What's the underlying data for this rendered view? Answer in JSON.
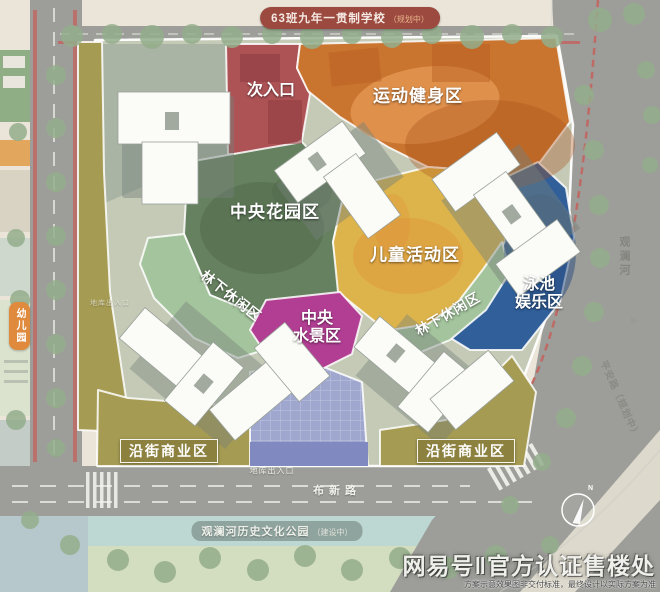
{
  "badges": {
    "school": {
      "name": "63班九年一贯制学校",
      "status": "（规划中）"
    },
    "kindergarten": {
      "name": "幼儿园"
    },
    "park": {
      "name": "观澜河历史文化公园",
      "status": "（建设中）"
    }
  },
  "zones": {
    "secondary_entrance": {
      "label": "次入口"
    },
    "sports": {
      "label": "运动健身区"
    },
    "garden": {
      "label": "中央花园区"
    },
    "children": {
      "label": "儿童活动区"
    },
    "forest_left": {
      "label": "林下休闲区"
    },
    "waterscape": {
      "line1": "中央",
      "line2": "水景区"
    },
    "forest_right": {
      "label": "林下休闲区"
    },
    "pool": {
      "line1": "泳池",
      "line2": "娱乐区"
    },
    "commercial_left": {
      "label": "沿街商业区"
    },
    "commercial_right": {
      "label": "沿街商业区"
    }
  },
  "roads": {
    "bottom": "布新路",
    "river": "观澜河",
    "right_road": "平安路（规划中）",
    "garage_south": "地库出入口",
    "garage_west": "地库出入口"
  },
  "compass": {
    "north": "N"
  },
  "icons": {
    "river_flow": "▶"
  },
  "watermark": {
    "brand": "网易号‖官方认证售楼处",
    "disclaimer": "方案示意效果图非交付标准，最终设计以实际方案为准"
  },
  "colors": {
    "bg": "#eae5d8",
    "road": "#9d9d99",
    "road_red": "#c4625c",
    "tree": "#94ae8c",
    "site_base": "#c4cab6",
    "zone_entrance": "#ad5356",
    "zone_sports": "#c9742f",
    "zone_sports_light": "#e59a55",
    "zone_garden": "#66815f",
    "zone_garden_dark": "#506a4b",
    "zone_children": "#ddb44b",
    "zone_children_orange": "#e0923a",
    "zone_forest": "#a3c49c",
    "zone_waterscape": "#b23e93",
    "zone_pool": "#305f9a",
    "zone_pool_dark": "#284e80",
    "zone_commercial": "#a59b53",
    "commercial_box": "#8d8140",
    "plaza": "#9fa7cf",
    "plaza_dark": "#8089c0",
    "building": "#fbfbf8",
    "building_stroke": "#98a098",
    "podium": "#75807a",
    "badge_school": "#9c4a40",
    "badge_school_status": "#e8b48a",
    "badge_kg": "#e08a3e",
    "park_strip": "#bdd8d3",
    "park_green": "#d3ddc0",
    "water": "#b6c8cb",
    "wedge_light": "#ddd9cc"
  }
}
